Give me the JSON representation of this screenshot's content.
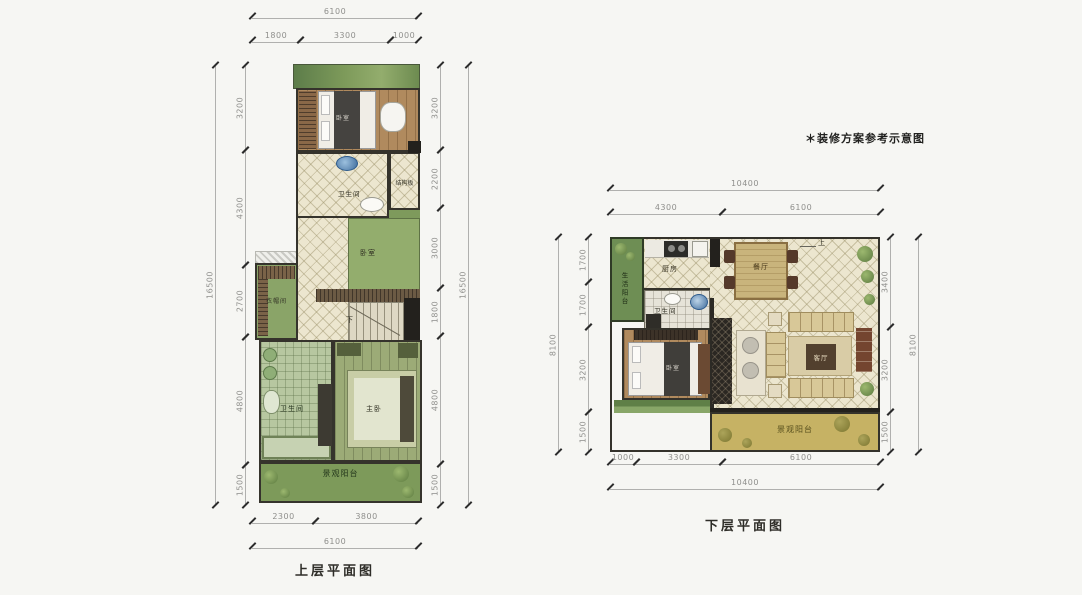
{
  "note": "＊装修方案参考示意图",
  "upper_plan": {
    "caption": "上层平面图",
    "rooms": {
      "bedroom_top": "卧室",
      "bathroom_top": "卫生间",
      "structure_slab": "结构板",
      "bedroom_mid": "卧室",
      "cloakroom": "衣帽间",
      "stairs_down": "下",
      "bathroom_lower": "卫生间",
      "master_bedroom": "主卧",
      "view_balcony": "景观阳台"
    },
    "dims": {
      "top_total": "6100",
      "top_segs": [
        "1800",
        "3300",
        "1000"
      ],
      "left_total": "16500",
      "left_segs": [
        "3200",
        "4300",
        "2700",
        "4800",
        "1500"
      ],
      "right_total": "16500",
      "right_segs": [
        "3200",
        "2200",
        "3000",
        "1800",
        "4800",
        "1500"
      ],
      "bottom_segs": [
        "2300",
        "3800"
      ],
      "bottom_total": "6100"
    }
  },
  "lower_plan": {
    "caption": "下层平面图",
    "rooms": {
      "service_balcony": "生活阳台",
      "kitchen": "厨房",
      "dining": "餐厅",
      "bathroom": "卫生间",
      "bedroom": "卧室",
      "living": "客厅",
      "stairs_up": "上",
      "view_balcony": "景观阳台"
    },
    "dims": {
      "top_total": "10400",
      "top_segs": [
        "4300",
        "6100"
      ],
      "left_total": "8100",
      "left_segs": [
        "1700",
        "1700",
        "3200",
        "1500"
      ],
      "right_total": "8100",
      "right_segs": [
        "3400",
        "3200",
        "1500"
      ],
      "bottom_segs": [
        "1000",
        "3300",
        "6100"
      ],
      "bottom_total": "10400"
    }
  },
  "colors": {
    "background": "#f6f6f3",
    "wall": "#23211d",
    "green_balcony": "#7d9a5a",
    "green_room": "#93ad6d",
    "tile_beige": "#ece6cf",
    "wood": "#b08a5e",
    "yellow_balcony": "#c6b264",
    "dim_line": "#b0b0ae",
    "dim_text": "#8f8f8c"
  }
}
